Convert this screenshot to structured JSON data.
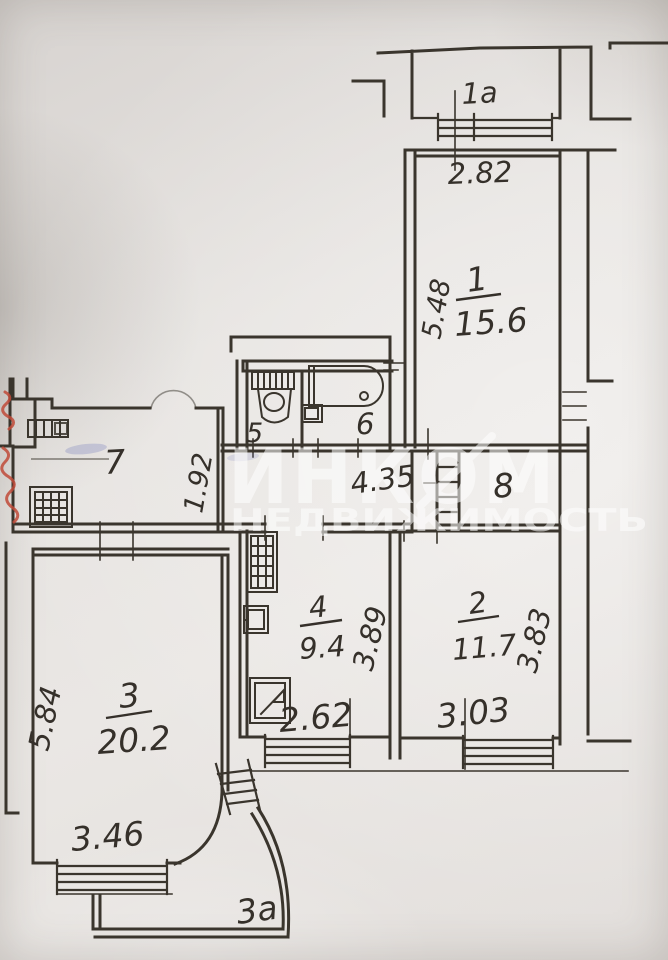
{
  "plan": {
    "watermark": {
      "brand": "ИНКОМ",
      "subtitle": "НЕДВИЖИМОСТЬ"
    },
    "rooms": {
      "room1": {
        "number": "1",
        "area": "15.6"
      },
      "room2": {
        "number": "2",
        "area": "11.7"
      },
      "room3": {
        "number": "3",
        "area": "20.2"
      },
      "room4": {
        "number": "4",
        "area": "9.4"
      },
      "room5": {
        "number": "5"
      },
      "room6": {
        "number": "6"
      },
      "room7": {
        "number": "7"
      },
      "room8": {
        "number": "8"
      },
      "balcony_top": {
        "number": "1а"
      },
      "balcony_bottom": {
        "number": "3а"
      }
    },
    "dimensions": {
      "top_window": "2.82",
      "room1_depth": "5.48",
      "kitchen_depth": "1.92",
      "hall_width": "4.35",
      "room4_depth": "3.89",
      "room2_depth": "3.83",
      "room3_depth": "5.84",
      "room4_width": "2.62",
      "room2_width": "3.03",
      "room3_width": "3.46"
    },
    "colors": {
      "ink": "#3a352d",
      "paper": "#e4e1de",
      "red_mark": "#c04a38",
      "blue_mark": "#7b84bd",
      "watermark": "#ffffff"
    }
  }
}
